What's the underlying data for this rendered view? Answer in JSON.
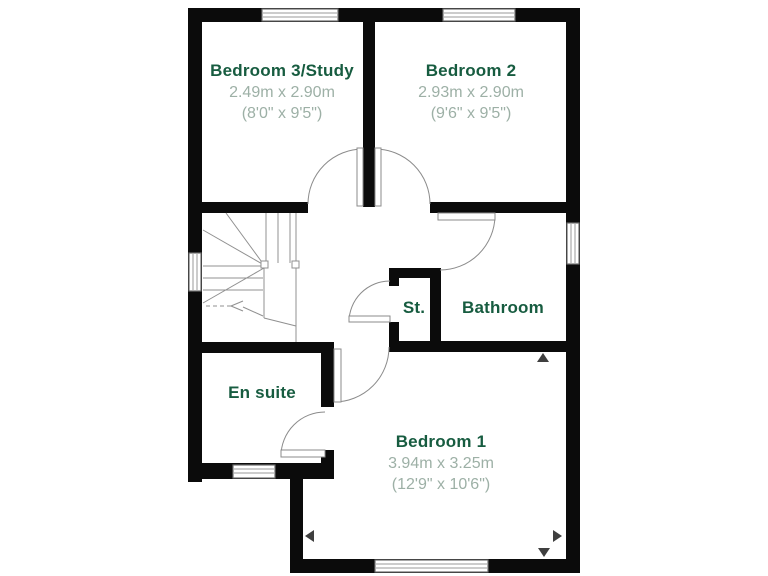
{
  "plan_type": "floor-plan",
  "rooms": {
    "bedroom3": {
      "name": "Bedroom 3/Study",
      "metric": "2.49m x 2.90m",
      "imperial": "(8'0\" x 9'5\")"
    },
    "bedroom2": {
      "name": "Bedroom 2",
      "metric": "2.93m x 2.90m",
      "imperial": "(9'6\" x 9'5\")"
    },
    "st": {
      "name": "St."
    },
    "bathroom": {
      "name": "Bathroom"
    },
    "ensuite": {
      "name": "En suite"
    },
    "bedroom1": {
      "name": "Bedroom 1",
      "metric": "3.94m x 3.25m",
      "imperial": "(12'9\" x 10'6\")"
    }
  },
  "colors": {
    "wall": "#0b0b0b",
    "room_name_text": "#175c40",
    "dimension_text": "#9db0a6",
    "detail_line": "#8b8b8b",
    "window_frame": "#6e6e6e",
    "dimension_marker": "#3f3f3f",
    "background": "#ffffff"
  }
}
